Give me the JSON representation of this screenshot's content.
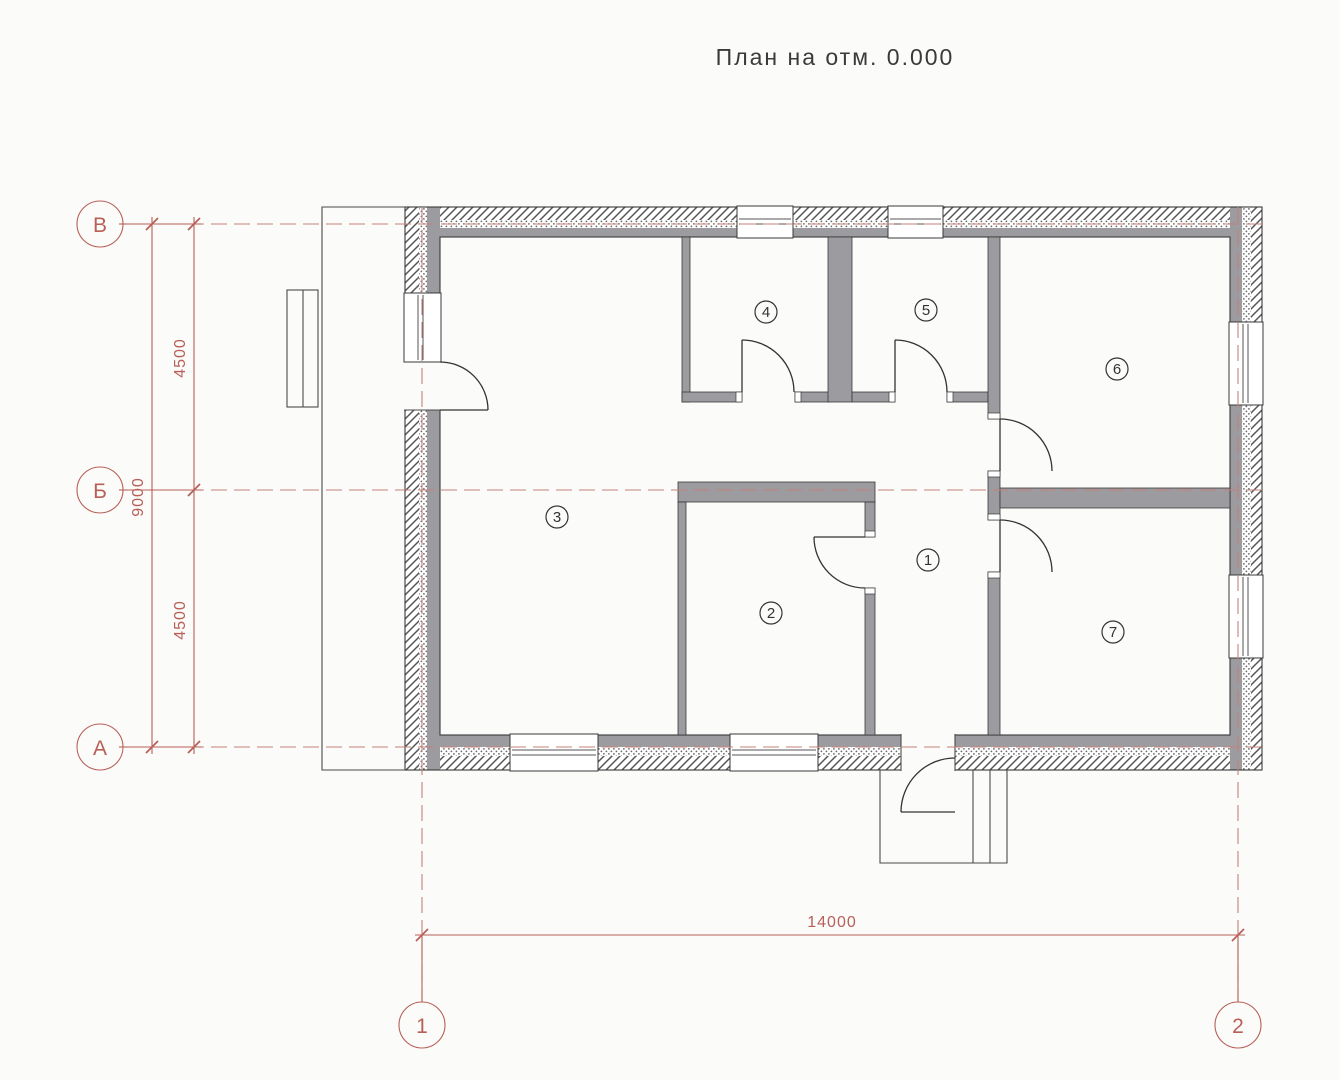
{
  "title": "План на отм. 0.000",
  "axes": {
    "rows": [
      {
        "label": "В"
      },
      {
        "label": "Б"
      },
      {
        "label": "А"
      }
    ],
    "cols": [
      {
        "label": "1"
      },
      {
        "label": "2"
      }
    ]
  },
  "dimensions": {
    "total_height": "9000",
    "upper_segment": "4500",
    "lower_segment": "4500",
    "total_width": "14000"
  },
  "rooms": [
    {
      "number": "1"
    },
    {
      "number": "2"
    },
    {
      "number": "3"
    },
    {
      "number": "4"
    },
    {
      "number": "5"
    },
    {
      "number": "6"
    },
    {
      "number": "7"
    }
  ],
  "colors": {
    "wall_fill": "#9b9ba0",
    "axis_red": "#b85f58",
    "line_dark": "#3a3a3a",
    "background": "#fbfbf9"
  }
}
